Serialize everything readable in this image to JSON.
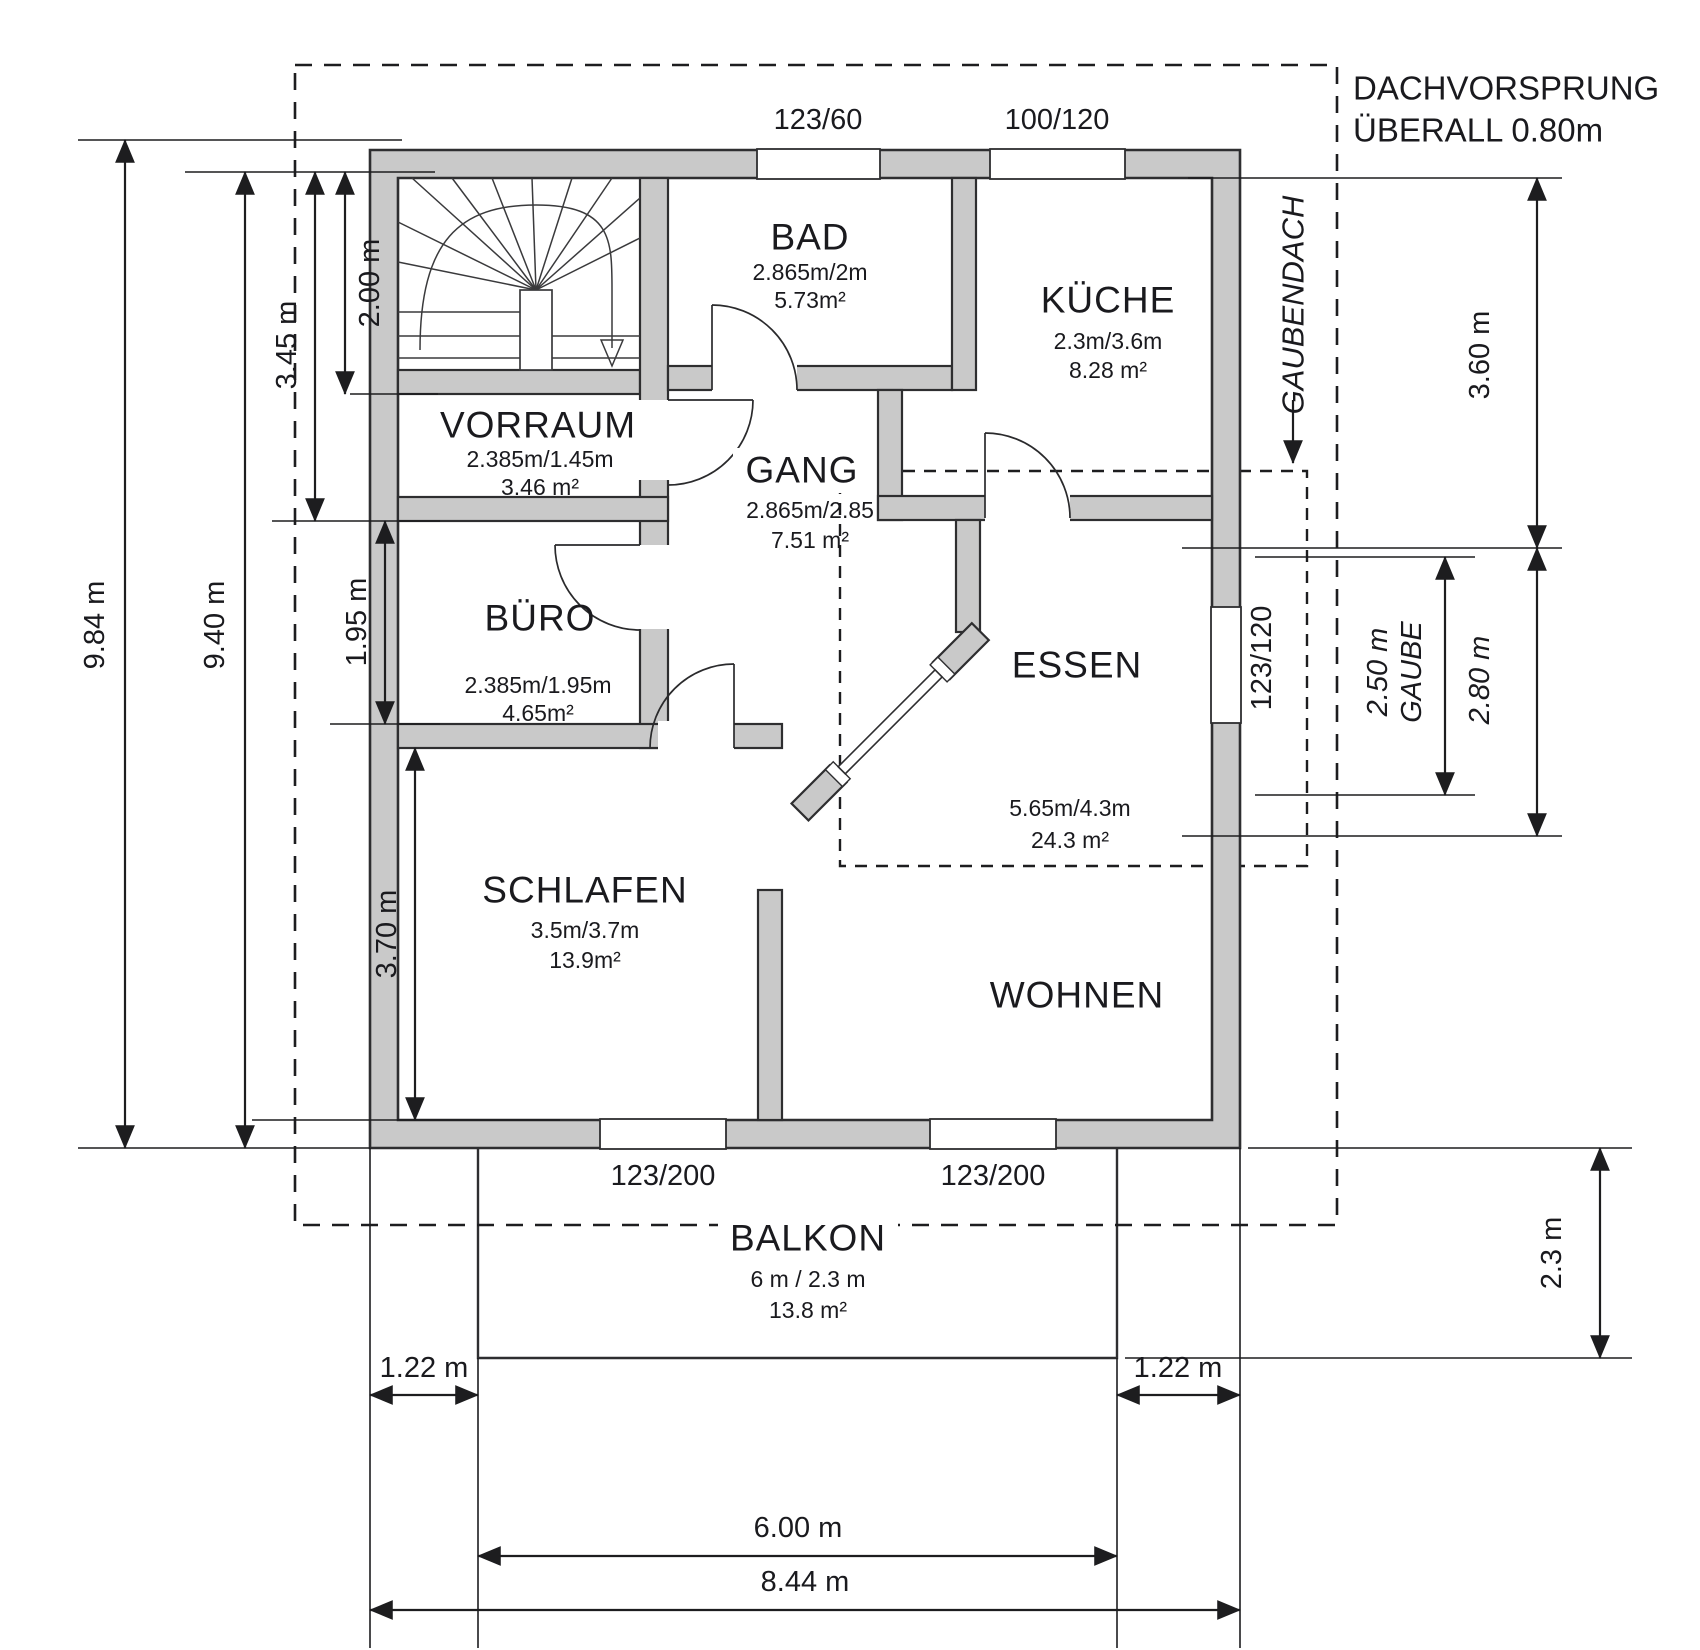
{
  "annotations": {
    "roof_line1": "DACHVORSPRUNG",
    "roof_line2": "ÜBERALL 0.80m",
    "gaubendach": "GAUBENDACH"
  },
  "rooms": {
    "bad": {
      "name": "BAD",
      "dims": "2.865m/2m",
      "area": "5.73m²"
    },
    "kueche": {
      "name": "KÜCHE",
      "dims": "2.3m/3.6m",
      "area": "8.28 m²"
    },
    "vorraum": {
      "name": "VORRAUM",
      "dims": "2.385m/1.45m",
      "area": "3.46 m²"
    },
    "gang": {
      "name": "GANG",
      "dims": "2.865m/2.85",
      "area": "7.51 m²"
    },
    "buero": {
      "name": "BÜRO",
      "dims": "2.385m/1.95m",
      "area": "4.65m²"
    },
    "essen": {
      "name": "ESSEN",
      "dims": "5.65m/4.3m",
      "area": "24.3 m²"
    },
    "schlafen": {
      "name": "SCHLAFEN",
      "dims": "3.5m/3.7m",
      "area": "13.9m²"
    },
    "wohnen": {
      "name": "WOHNEN"
    },
    "balkon": {
      "name": "BALKON",
      "dims": "6 m / 2.3 m",
      "area": "13.8 m²"
    }
  },
  "windows": {
    "bad": "123/60",
    "kueche": "100/120",
    "essen": "123/120",
    "schlafen": "123/200",
    "wohnen": "123/200"
  },
  "dimensions": {
    "left": {
      "total": "9.84 m",
      "inner": "9.40 m",
      "upper": "3.45 m",
      "stairs": "2.00 m",
      "buero": "1.95 m",
      "schlafen": "3.70 m"
    },
    "right": {
      "kueche": "3.60 m",
      "gaube_total": "2.80 m",
      "gaube_width": "2.50 m",
      "gaube_word": "GAUBE",
      "balkon_depth": "2.3 m"
    },
    "bottom": {
      "left_offset": "1.22 m",
      "right_offset": "1.22 m",
      "balkon_width": "6.00 m",
      "total": "8.44 m"
    }
  },
  "colors": {
    "wall_fill": "#c9c9c9",
    "line": "#1d1d1f"
  }
}
